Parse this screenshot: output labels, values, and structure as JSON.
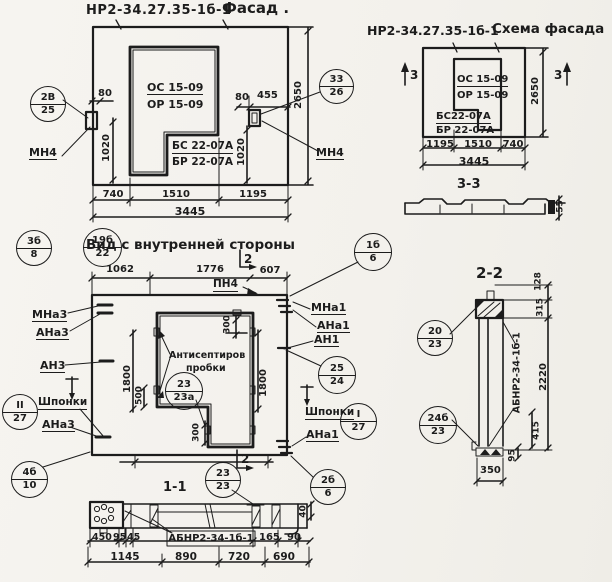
{
  "paper": "#f5f3ef",
  "ink": "#1c1c1c",
  "titles": {
    "facade_code": "НР2-34.27.35-1б-1",
    "facade_name": "Фасад .",
    "schema_code": "НР2-34.27.35-1б-1",
    "schema_name": "Схема фасада",
    "inner_view": "Вид с внутренней стороны",
    "section11": "1-1",
    "section22": "2-2",
    "section33": "3-3"
  },
  "panel_marks": {
    "os": "ОС 15-09",
    "or": "ОР 15-09",
    "bs": "БС 22-07А",
    "br": "БР 22-07А",
    "bs2": "БС22-07А",
    "br2": "БР 22-07А",
    "abnr": "АБНР2-34-1б-1"
  },
  "labels": {
    "mn4": "МН4",
    "pn4": "ПН4",
    "mna3": "МНа3",
    "ana3": "АНа3",
    "an3": "АН3",
    "mna1": "МНа1",
    "ana1": "АНа1",
    "an1": "АН1",
    "shponki": "Шпонки",
    "antiseptic_line1": "Антисептиров",
    "antiseptic_line2": "пробки",
    "sec2": "2",
    "sec3": "3"
  },
  "markers": {
    "m2v25": {
      "t": "2В",
      "b": "25"
    },
    "m33_26": {
      "t": "33",
      "b": "26"
    },
    "m3b8": {
      "t": "3б",
      "b": "8"
    },
    "m19b22": {
      "t": "19б",
      "b": "22"
    },
    "m1b6": {
      "t": "1б",
      "b": "6"
    },
    "mII27": {
      "t": "II",
      "b": "27"
    },
    "m23_23a": {
      "t": "23",
      "b": "23а"
    },
    "m25_24": {
      "t": "25",
      "b": "24"
    },
    "mI27": {
      "t": "I",
      "b": "27"
    },
    "m4b10": {
      "t": "4б",
      "b": "10"
    },
    "m2b6": {
      "t": "2б",
      "b": "6"
    },
    "m23_23": {
      "t": "23",
      "b": "23"
    },
    "m20_23": {
      "t": "20",
      "b": "23"
    },
    "m24b23": {
      "t": "24б",
      "b": "23"
    }
  },
  "dims": {
    "d40": "40",
    "d45": "45",
    "d55": "55",
    "d80": "80",
    "d90": "90",
    "d95": "95",
    "d128": "128",
    "d165": "165",
    "d300": "300",
    "d315": "315",
    "d350": "350",
    "d415": "415",
    "d450": "450",
    "d455": "455",
    "d500": "500",
    "d607": "607",
    "d690": "690",
    "d720": "720",
    "d740": "740",
    "d890": "890",
    "d1020": "1020",
    "d1062": "1062",
    "d1145": "1145",
    "d1195": "1195",
    "d1510": "1510",
    "d1776": "1776",
    "d1800": "1800",
    "d2220": "2220",
    "d2650": "2650",
    "d3445": "3445"
  }
}
